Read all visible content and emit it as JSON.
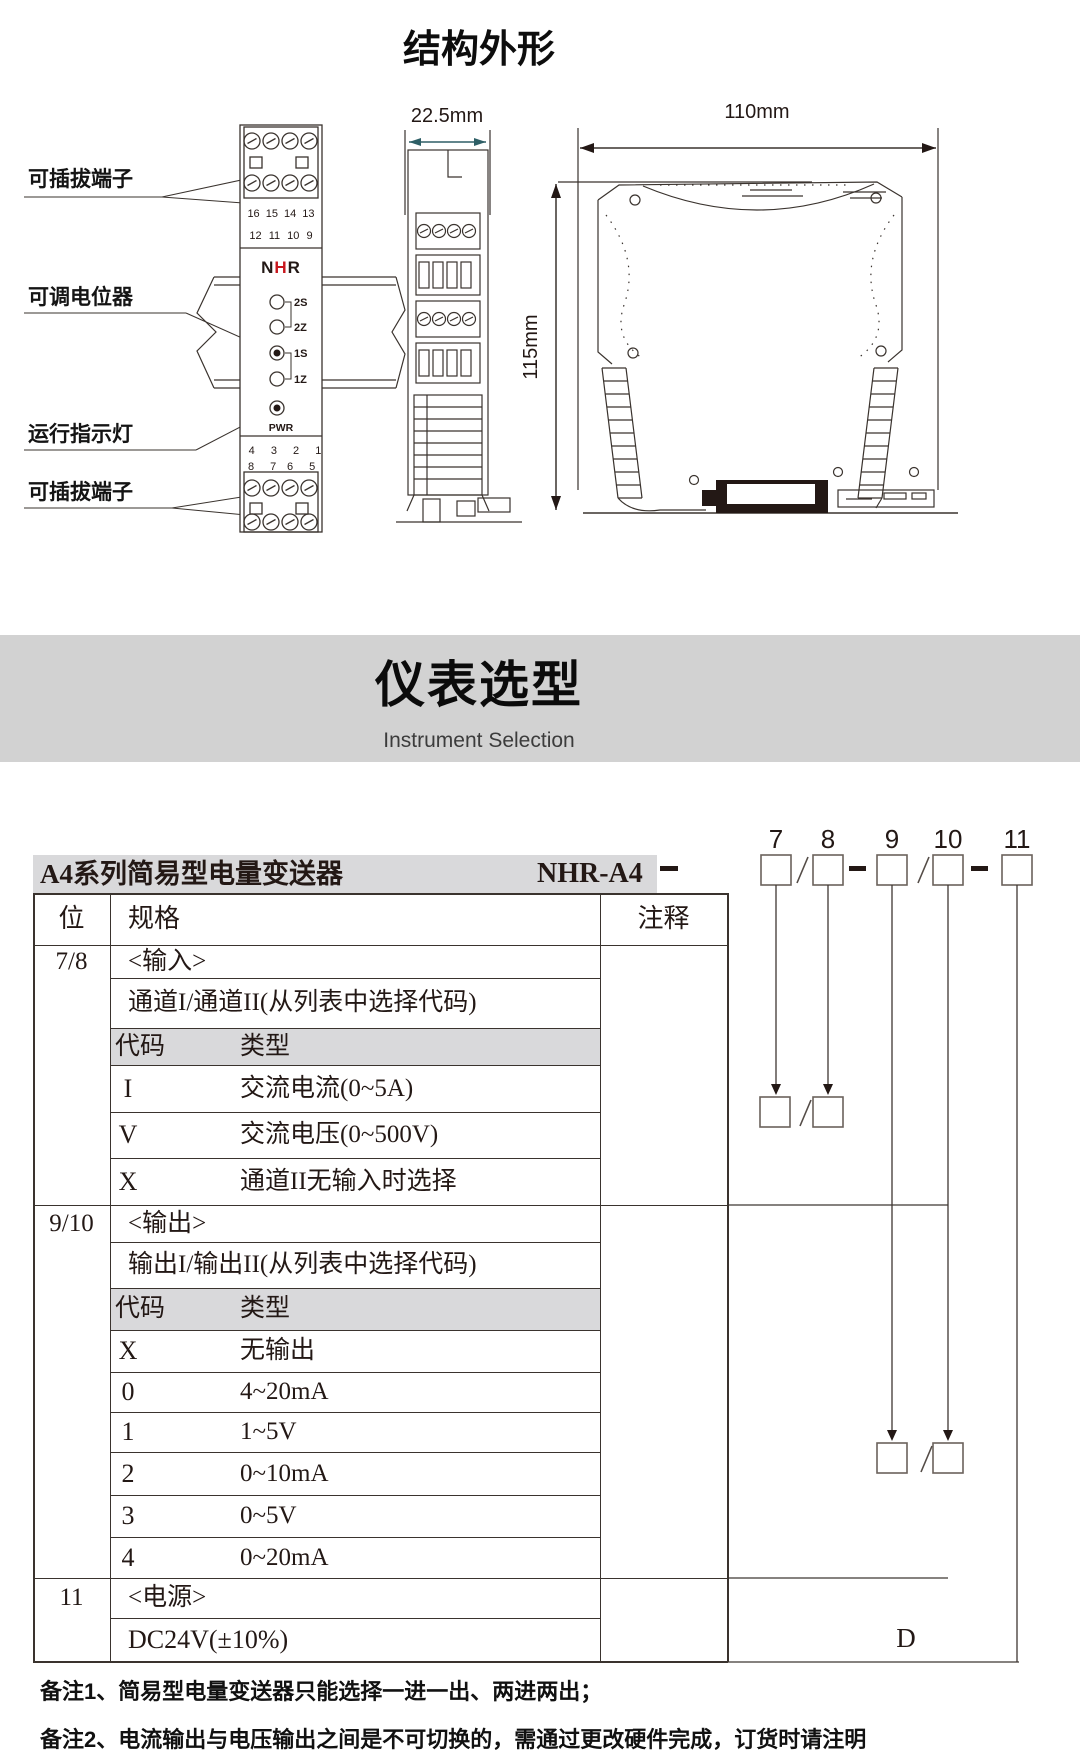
{
  "structure": {
    "title": "结构外形",
    "labels": {
      "terminal_top": "可插拔端子",
      "potentiometer": "可调电位器",
      "run_indicator": "运行指示灯",
      "terminal_bottom": "可插拔端子"
    },
    "front": {
      "logo": {
        "n": "N",
        "h": "H",
        "r": "R"
      },
      "top_numbers_row1": "16 15 14 13",
      "top_numbers_row2": "12 11 10 9",
      "pots": [
        "2S",
        "2Z",
        "1S",
        "1Z"
      ],
      "led": "PWR",
      "bottom_row1": "4 3 2 1",
      "bottom_row2_red": "8 7",
      "bottom_row2_black": "6 5"
    },
    "dims": {
      "width": "22.5mm",
      "length": "110mm",
      "height": "115mm"
    }
  },
  "selection": {
    "title": "仪表选型",
    "subtitle": "Instrument Selection"
  },
  "ordering": {
    "product": "A4系列简易型电量变送器",
    "model": "NHR-A4",
    "digits": [
      "7",
      "8",
      "9",
      "10",
      "11"
    ],
    "power_code": "D",
    "headers": {
      "pos": "位",
      "spec": "规格",
      "note": "注释"
    },
    "sections": [
      {
        "pos": "7/8",
        "name": "<输入>",
        "desc": "通道I/通道II(从列表中选择代码)",
        "code_h": "代码",
        "type_h": "类型",
        "rows": [
          {
            "c": "I",
            "t": "交流电流(0~5A)"
          },
          {
            "c": "V",
            "t": "交流电压(0~500V)"
          },
          {
            "c": "X",
            "t": "通道II无输入时选择"
          }
        ]
      },
      {
        "pos": "9/10",
        "name": "<输出>",
        "desc": "输出I/输出II(从列表中选择代码)",
        "code_h": "代码",
        "type_h": "类型",
        "rows": [
          {
            "c": "X",
            "t": "无输出"
          },
          {
            "c": "0",
            "t": "4~20mA"
          },
          {
            "c": "1",
            "t": "1~5V"
          },
          {
            "c": "2",
            "t": "0~10mA"
          },
          {
            "c": "3",
            "t": "0~5V"
          },
          {
            "c": "4",
            "t": "0~20mA"
          }
        ]
      },
      {
        "pos": "11",
        "name": "<电源>",
        "desc": "DC24V(±10%)"
      }
    ],
    "notes": [
      "备注1、简易型电量变送器只能选择一进一出、两进两出；",
      "备注2、电流输出与电压输出之间是不可切换的，需通过更改硬件完成，订货时请注明"
    ]
  },
  "colors": {
    "ink": "#231815",
    "accent_red": "#c8161d",
    "band_gray": "#d2d2d2",
    "row_gray": "#d9d9db",
    "dim_teal": "#2e5f66"
  }
}
